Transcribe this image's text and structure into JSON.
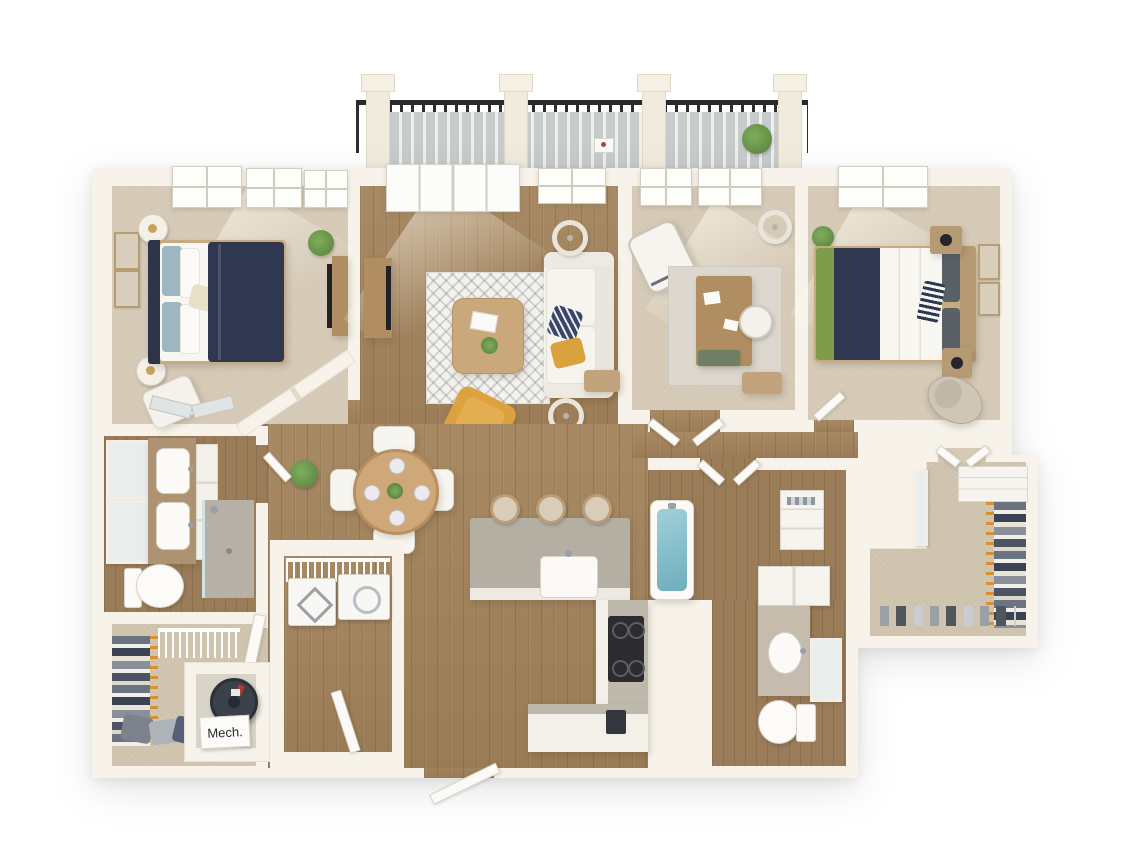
{
  "title": "3D apartment floor plan rendering, top-down view",
  "labels": {
    "mech": "Mech."
  },
  "palette": {
    "background": "#ffffff",
    "wall": "#f7f3ea",
    "wood_floor": "#a2825a",
    "carpet": "#d5c9b6",
    "balcony_deck": "#c9cdcd",
    "railing_black": "#2c2c2e",
    "duvet_navy": "#2f3850",
    "blanket_green": "#7f9b4c",
    "accent_chair_yellow": "#dda23e",
    "island_counter_gray": "#b5afa3",
    "tub_teal": "#7fb9c6",
    "hanger_orange": "#d9912f"
  },
  "balcony": {
    "posts": "4 cream pergola posts",
    "railing": "black metal balusters",
    "deck": "gray wood planks",
    "decor": [
      "potted-plant",
      "serving-tray"
    ]
  },
  "rooms": [
    {
      "id": "bedroom-1",
      "floor": "carpet",
      "windows": 3,
      "furniture": [
        "bed-navy-duvet",
        "nightstand-with-lamp",
        "nightstand-with-lamp",
        "wall-art",
        "wall-art",
        "accent-chair",
        "media-console-tv",
        "potted-plant"
      ]
    },
    {
      "id": "living-room",
      "floor": "hardwood",
      "balcony_door": true,
      "furniture": [
        "white-sofa",
        "navy-pattern-rug",
        "coffee-table",
        "floor-lamp",
        "floor-lamp",
        "yellow-armchair",
        "media-console-tv",
        "side-chair"
      ]
    },
    {
      "id": "office-den",
      "floor": "carpet",
      "windows": 2,
      "french_doors": true,
      "furniture": [
        "desk",
        "office-chair",
        "white-accent-chair",
        "floor-lamp",
        "rug",
        "green-bench",
        "side-chair"
      ]
    },
    {
      "id": "bedroom-2",
      "floor": "carpet",
      "windows": 1,
      "furniture": [
        "bed-green-navy-white",
        "nightstand-with-lamp",
        "nightstand-with-lamp",
        "wall-art",
        "wall-art",
        "desk-chair",
        "potted-plant"
      ]
    },
    {
      "id": "walk-in-closet-right",
      "floor": "carpet",
      "features": [
        "hanging-clothes",
        "shelving",
        "shoe-row",
        "mirror"
      ]
    },
    {
      "id": "bathroom-1",
      "floor": "hardwood",
      "features": [
        "double-vanity",
        "two-mirrors",
        "toilet",
        "walk-in-shower",
        "mirrored-closet-doors"
      ]
    },
    {
      "id": "bathroom-2",
      "floor": "hardwood",
      "features": [
        "soaking-tub-teal",
        "linen-shelves",
        "vanity",
        "mirror",
        "toilet",
        "over-toilet-cabinet"
      ]
    },
    {
      "id": "walk-in-closet-left",
      "floor": "carpet",
      "features": [
        "hanging-clothes",
        "wire-shelving",
        "clothes-pile"
      ]
    },
    {
      "id": "mechanical-closet",
      "label": "Mech.",
      "features": [
        "water-heater"
      ]
    },
    {
      "id": "laundry-closet",
      "floor": "hardwood",
      "features": [
        "washer",
        "dryer",
        "wire-shelf"
      ]
    },
    {
      "id": "kitchen",
      "floor": "hardwood",
      "features": [
        "island-with-sink",
        "bar-stool",
        "bar-stool",
        "bar-stool",
        "range-cooktop",
        "l-shaped-counter",
        "coffee-maker"
      ]
    },
    {
      "id": "dining-area",
      "floor": "hardwood",
      "features": [
        "round-table",
        "chair",
        "chair",
        "chair",
        "chair",
        "plates",
        "green-centerpiece",
        "potted-plant"
      ]
    },
    {
      "id": "entry",
      "features": [
        "front-door-open"
      ]
    }
  ]
}
